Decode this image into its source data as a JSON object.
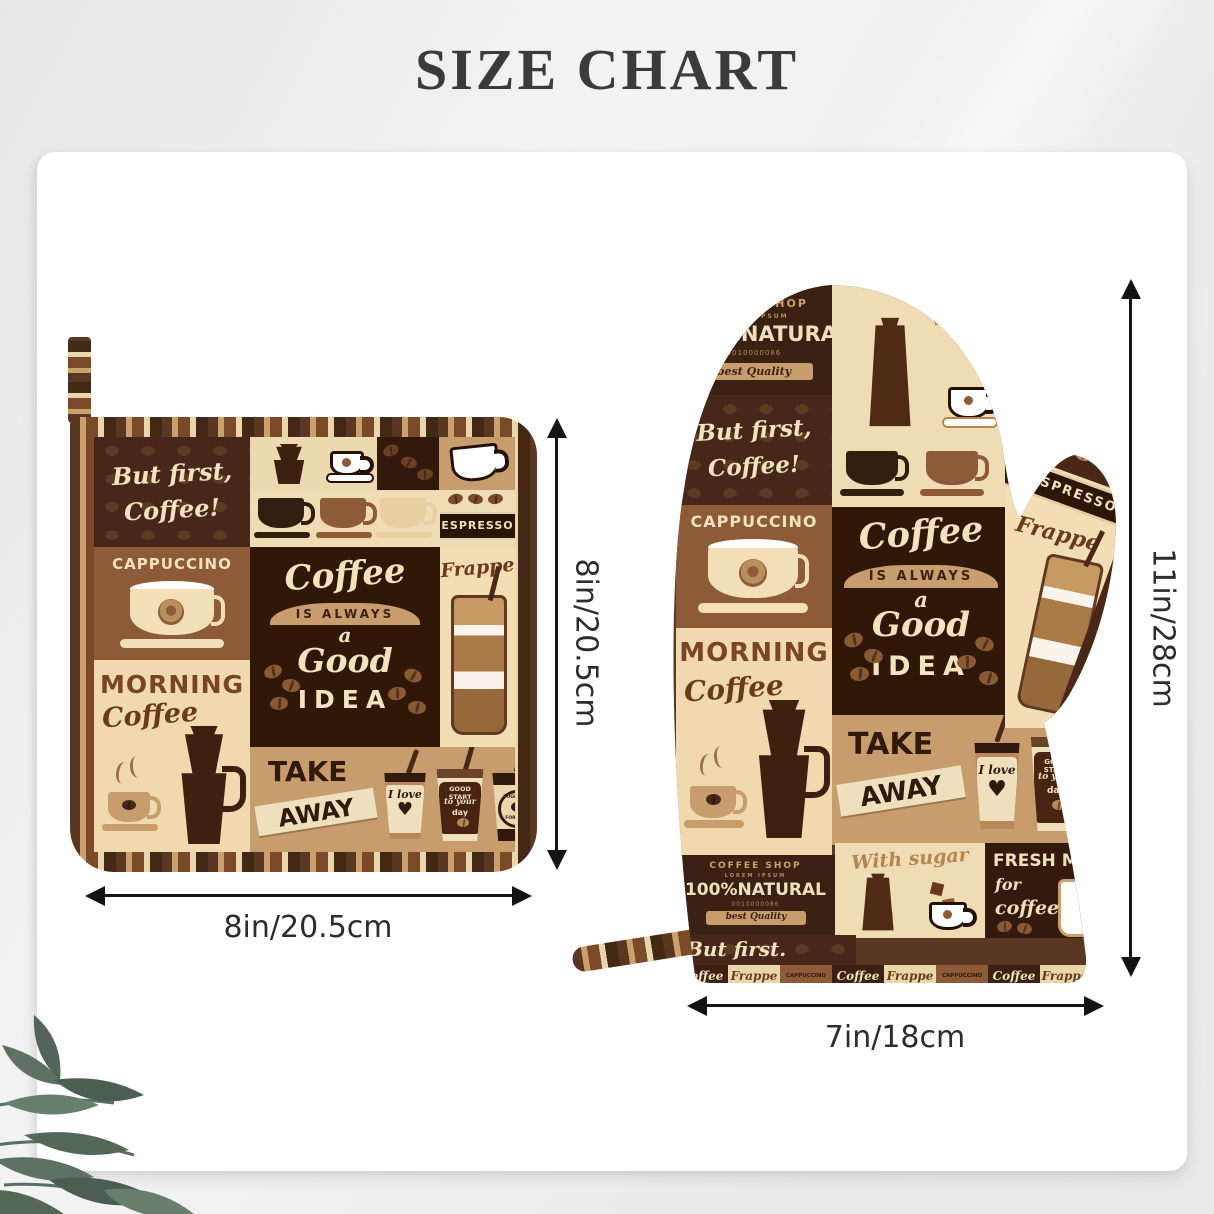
{
  "title": "SIZE CHART",
  "dimensions": {
    "potholder_width": "8in/20.5cm",
    "potholder_height": "8in/20.5cm",
    "mitt_height": "11in/28cm",
    "mitt_width": "7in/18cm"
  },
  "pattern": {
    "but_first": "But first,",
    "coffee_excl": "Coffee!",
    "but_first_dot": "But first.",
    "cappuccino": "CAPPUCCINO",
    "morning": "MORNING",
    "coffee_script": "Coffee",
    "espresso": "ESPRESSO",
    "is_always": "IS ALWAYS",
    "a_word": "a",
    "good": "Good",
    "idea": "IDEA",
    "frappe": "Frappe",
    "take": "TAKE",
    "away": "AWAY",
    "i_love": "I love",
    "good_start": "GOOD START",
    "to_your": "to your",
    "day": "day",
    "together": "TOGETHER",
    "forever": "FOREVER",
    "coffee_shop": "COFFEE SHOP",
    "lorem_ipsum": "LOREM IPSUM",
    "natural": "100%NATURAL",
    "serial": "0010000086",
    "best_quality": "best Quality",
    "with_word": "With",
    "with_sugar": "With sugar",
    "fresh_m": "FRESH M",
    "for_word": "for",
    "coffee_lower": "coffee"
  },
  "colors": {
    "dark_brown": "#3a2113",
    "chocolate": "#311708",
    "medium_brown": "#8d5b38",
    "tan": "#c89d6e",
    "cream": "#f0dcb4",
    "cream_text": "#f2e2bd"
  }
}
